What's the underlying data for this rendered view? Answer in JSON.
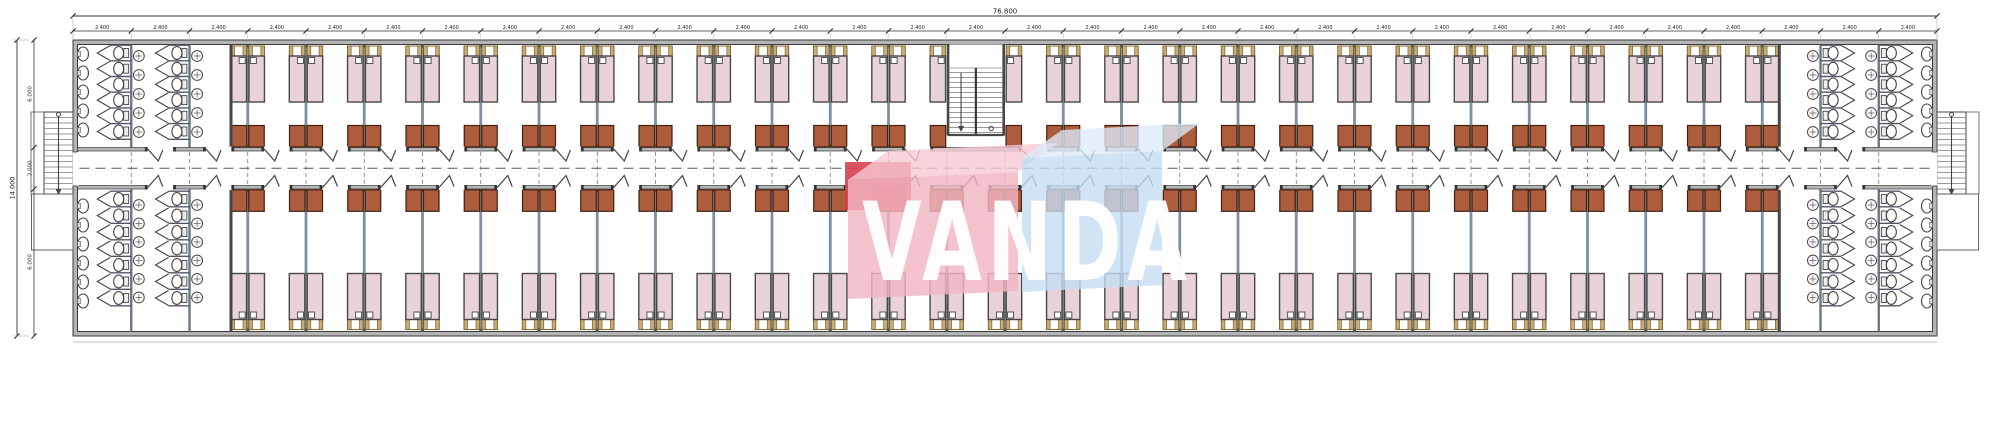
{
  "drawing_type": "modular dormitory floor plan",
  "dimensions": {
    "overall_width_label": "76.800",
    "bay_width_label": "2.400",
    "bay_count": 32,
    "overall_height_label": "14.000",
    "height_segment_labels": [
      "6.000",
      "2.000",
      "6.000"
    ]
  },
  "watermark": {
    "text": "VANDA",
    "pink_box_color": "#f2b6c2",
    "red_box_color": "#d6404f",
    "blue_box_color": "#c5ddf2",
    "letter_color": "#ffffff"
  },
  "palette": {
    "wall_fill": "#b5b5b5",
    "line_dark": "#3c3c3c",
    "partition_gray_blue": "#7f8f9f",
    "stall_wall": "#6a7884",
    "bed_mattress_pink": "#e9d3d9",
    "bed_frame_tan": "#c9ad72",
    "locker_brown": "#ad5c3c",
    "fixture_outline": "#444444",
    "dimension_text": "#222222"
  }
}
